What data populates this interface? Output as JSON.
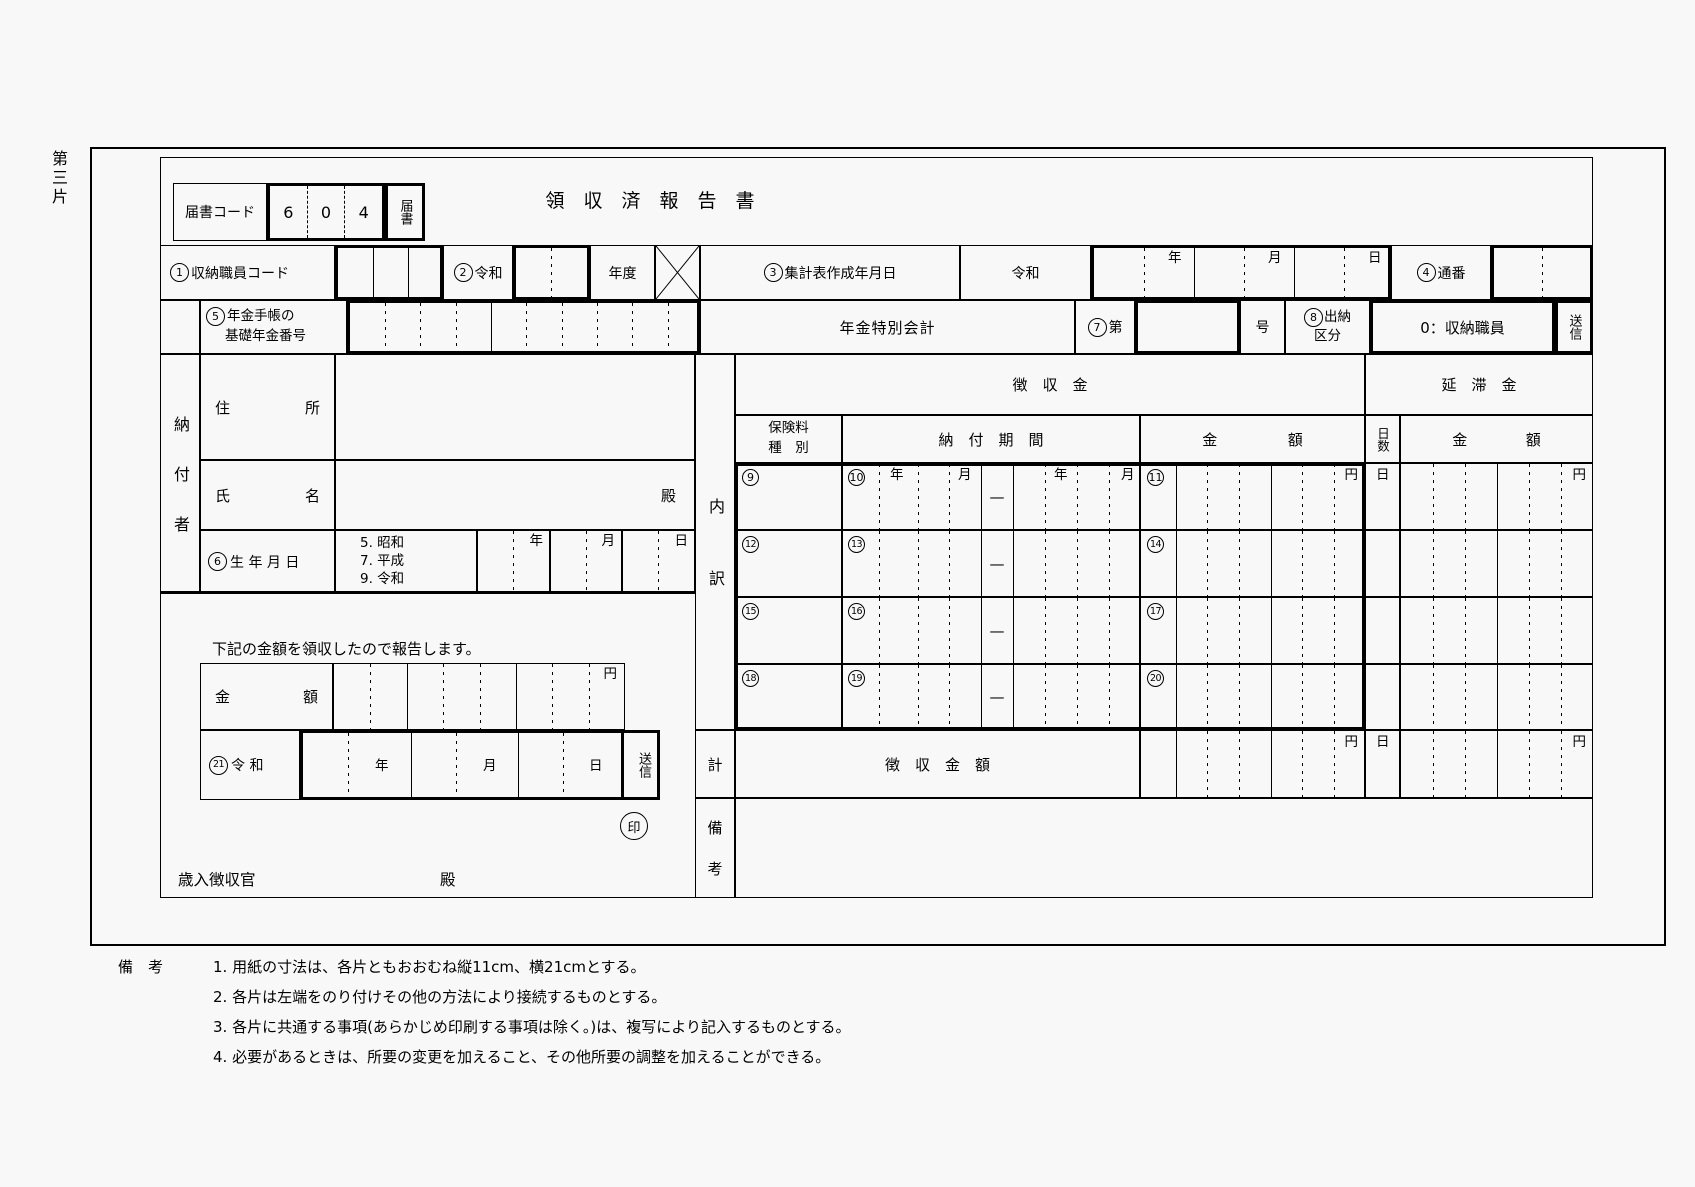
{
  "page": {
    "side_label": "第三片"
  },
  "header": {
    "code_label": "届書コード",
    "code_digits": [
      "6",
      "0",
      "4"
    ],
    "code_tab": "届書",
    "title": "領　収　済　報　告　書"
  },
  "row1": {
    "staff_num": "1",
    "staff_label": "収納職員コード",
    "era_num": "2",
    "era_label": "令和",
    "nendo": "年度",
    "date_num": "3",
    "date_label": "集計表作成年月日",
    "reiwa": "令和",
    "year": "年",
    "month": "月",
    "day": "日",
    "serial_num": "4",
    "serial_label": "通番"
  },
  "row2": {
    "pension_num": "5",
    "pension_l1": "年金手帳の",
    "pension_l2": "基礎年金番号",
    "account": "年金特別会計",
    "dai_num": "7",
    "dai_label": "第",
    "go": "号",
    "suito_num": "8",
    "suito_l1": "出納",
    "suito_l2": "区分",
    "suito_value": "0：収納職員",
    "send": "送信"
  },
  "payer": {
    "group": "納付者",
    "addr_l": "住",
    "addr_r": "所",
    "name_l": "氏",
    "name_r": "名",
    "dono": "殿",
    "birth_num": "6",
    "birth_label": "生 年 月 日",
    "eras": [
      "5. 昭和",
      "7. 平成",
      "9. 令和"
    ],
    "year": "年",
    "month": "月",
    "day": "日"
  },
  "report": {
    "statement": "下記の金額を領収したので報告します。",
    "amt_l": "金",
    "amt_r": "額",
    "yen": "円",
    "date_num": "21",
    "date_label": "令 和",
    "year": "年",
    "month": "月",
    "day": "日",
    "send": "送信",
    "seal": "印",
    "officer": "歳入徴収官",
    "dono": "殿"
  },
  "detail": {
    "group": "内訳",
    "choshu_header": "徴　収　金",
    "entai_header": "延　滞　金",
    "type_l1": "保険料",
    "type_l2": "種　別",
    "period_header": "納　付　期　間",
    "amt_l": "金",
    "amt_r": "額",
    "days": "日数",
    "year": "年",
    "month": "月",
    "day": "日",
    "yen": "円",
    "dash": "—",
    "rows": [
      {
        "t": "9",
        "p": "10",
        "a": "11"
      },
      {
        "t": "12",
        "p": "13",
        "a": "14"
      },
      {
        "t": "15",
        "p": "16",
        "a": "17"
      },
      {
        "t": "18",
        "p": "19",
        "a": "20"
      }
    ],
    "total_kei": "計",
    "total_label": "徴　収　金　額",
    "remarks": "備考"
  },
  "notes": {
    "label": "備　考",
    "items": [
      "1. 用紙の寸法は、各片ともおおむね縦11cm、横21cmとする。",
      "2. 各片は左端をのり付けその他の方法により接続するものとする。",
      "3. 各片に共通する事項(あらかじめ印刷する事項は除く。)は、複写により記入するものとする。",
      "4. 必要があるときは、所要の変更を加えること、その他所要の調整を加えることができる。"
    ]
  }
}
